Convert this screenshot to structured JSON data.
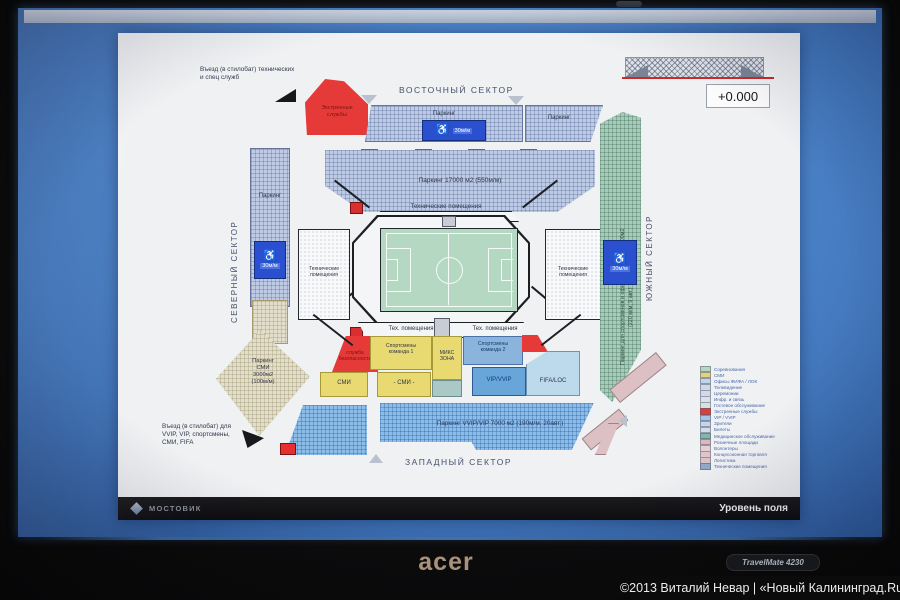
{
  "colors": {
    "desktop_blue": "#4c84ca",
    "page_white": "#eff1f3",
    "plan_blue": "#bfcbe4",
    "parking_blue": "#8cbde9",
    "south_green": "#a9ccba",
    "field_green": "#b5d8c3",
    "media_beige": "#e2decb",
    "zone_yellow": "#e8da70",
    "zone_red": "#e63a38",
    "vip_blue": "#68a6da",
    "fifa_blue": "#bcdaec",
    "pink": "#dcc0c4",
    "red_line": "#cc2a2a"
  },
  "laptop": {
    "brand": "acer",
    "model": "TravelMate 4230"
  },
  "watermark": "©2013 Виталий Невар | «Новый Калининград.Ru»",
  "footer": {
    "logo": "МОСТОВИК",
    "caption": "Уровень поля"
  },
  "elevation": "+0.000",
  "sectors": {
    "east": "ВОСТОЧНЫЙ СЕКТОР",
    "north": "СЕВЕРНЫЙ СЕКТОР",
    "south": "ЮЖНЫЙ СЕКТОР",
    "west": "ЗАПАДНЫЙ СЕКТОР"
  },
  "entries": {
    "top": "Въезд (в стилобат) технических\nи спец служб",
    "bottom": "Въезд (в стилобат) для\nVVIP, VIP, спортсмены,\nСМИ, FIFA"
  },
  "areas": {
    "emergency": "Экстренные\nслужбы",
    "parking_east1": "Паркинг",
    "parking_east2": "Паркинг",
    "parking_north": "Паркинг",
    "disabled_30": "30м/м",
    "parking_main": "Паркинг  17000 м2 (550м/м)",
    "tech_full": "Технические помещения",
    "tech_2line": "Технические\nпомещения",
    "tech_short": "Тех. помещения",
    "parking_media": "Паркинг\nСМИ\n3000м2\n(100м/м)",
    "parking_south_main": "Паркинг для спортсменов и официальных лиц 6400м2",
    "parking_south_sub": "(220 м/м, 9 авт.)",
    "security": "служба\nбезопасности",
    "team1": "Спортсмены\nкоманда 1",
    "mix": "МИКС\nЗОНА",
    "team2": "Спортсмены\nкоманда 2",
    "smi": "СМИ",
    "smi2": "- СМИ -",
    "vip": "VIP/VVIP",
    "fifa": "FIFA/LOC",
    "parking_vip": "Паркинг VVIP/VIP 7000 м2 (190м/м, 20авт.)"
  },
  "legend": [
    {
      "label": "Соревнования",
      "color": "#b8d4c4"
    },
    {
      "label": "СМИ",
      "color": "#e0d484"
    },
    {
      "label": "Офисы ФИФА / ЛОК",
      "color": "#c4d4e8"
    },
    {
      "label": "Телевидение",
      "color": "#d0d8e8"
    },
    {
      "label": "Церемонии",
      "color": "#d4d8e8"
    },
    {
      "label": "Инфр. и связь",
      "color": "#dce0ec"
    },
    {
      "label": "Гостевое обслуживание",
      "color": "#d4e4dc"
    },
    {
      "label": "Экстренные службы",
      "color": "#d84040"
    },
    {
      "label": "VIP / VVIP",
      "color": "#a8c4e4"
    },
    {
      "label": "Зрители",
      "color": "#c8d4e8"
    },
    {
      "label": "Билеты",
      "color": "#d4dce8"
    },
    {
      "label": "Медицинское обслуживание",
      "color": "#84b4ac"
    },
    {
      "label": "Розничные площади",
      "color": "#dcb8bc"
    },
    {
      "label": "Волонтеры",
      "color": "#e4d0d4"
    },
    {
      "label": "Концессионная торговля",
      "color": "#e0c4c8"
    },
    {
      "label": "Логистика",
      "color": "#d8c4c8"
    },
    {
      "label": "Технические помещения",
      "color": "#94a8c8"
    }
  ]
}
